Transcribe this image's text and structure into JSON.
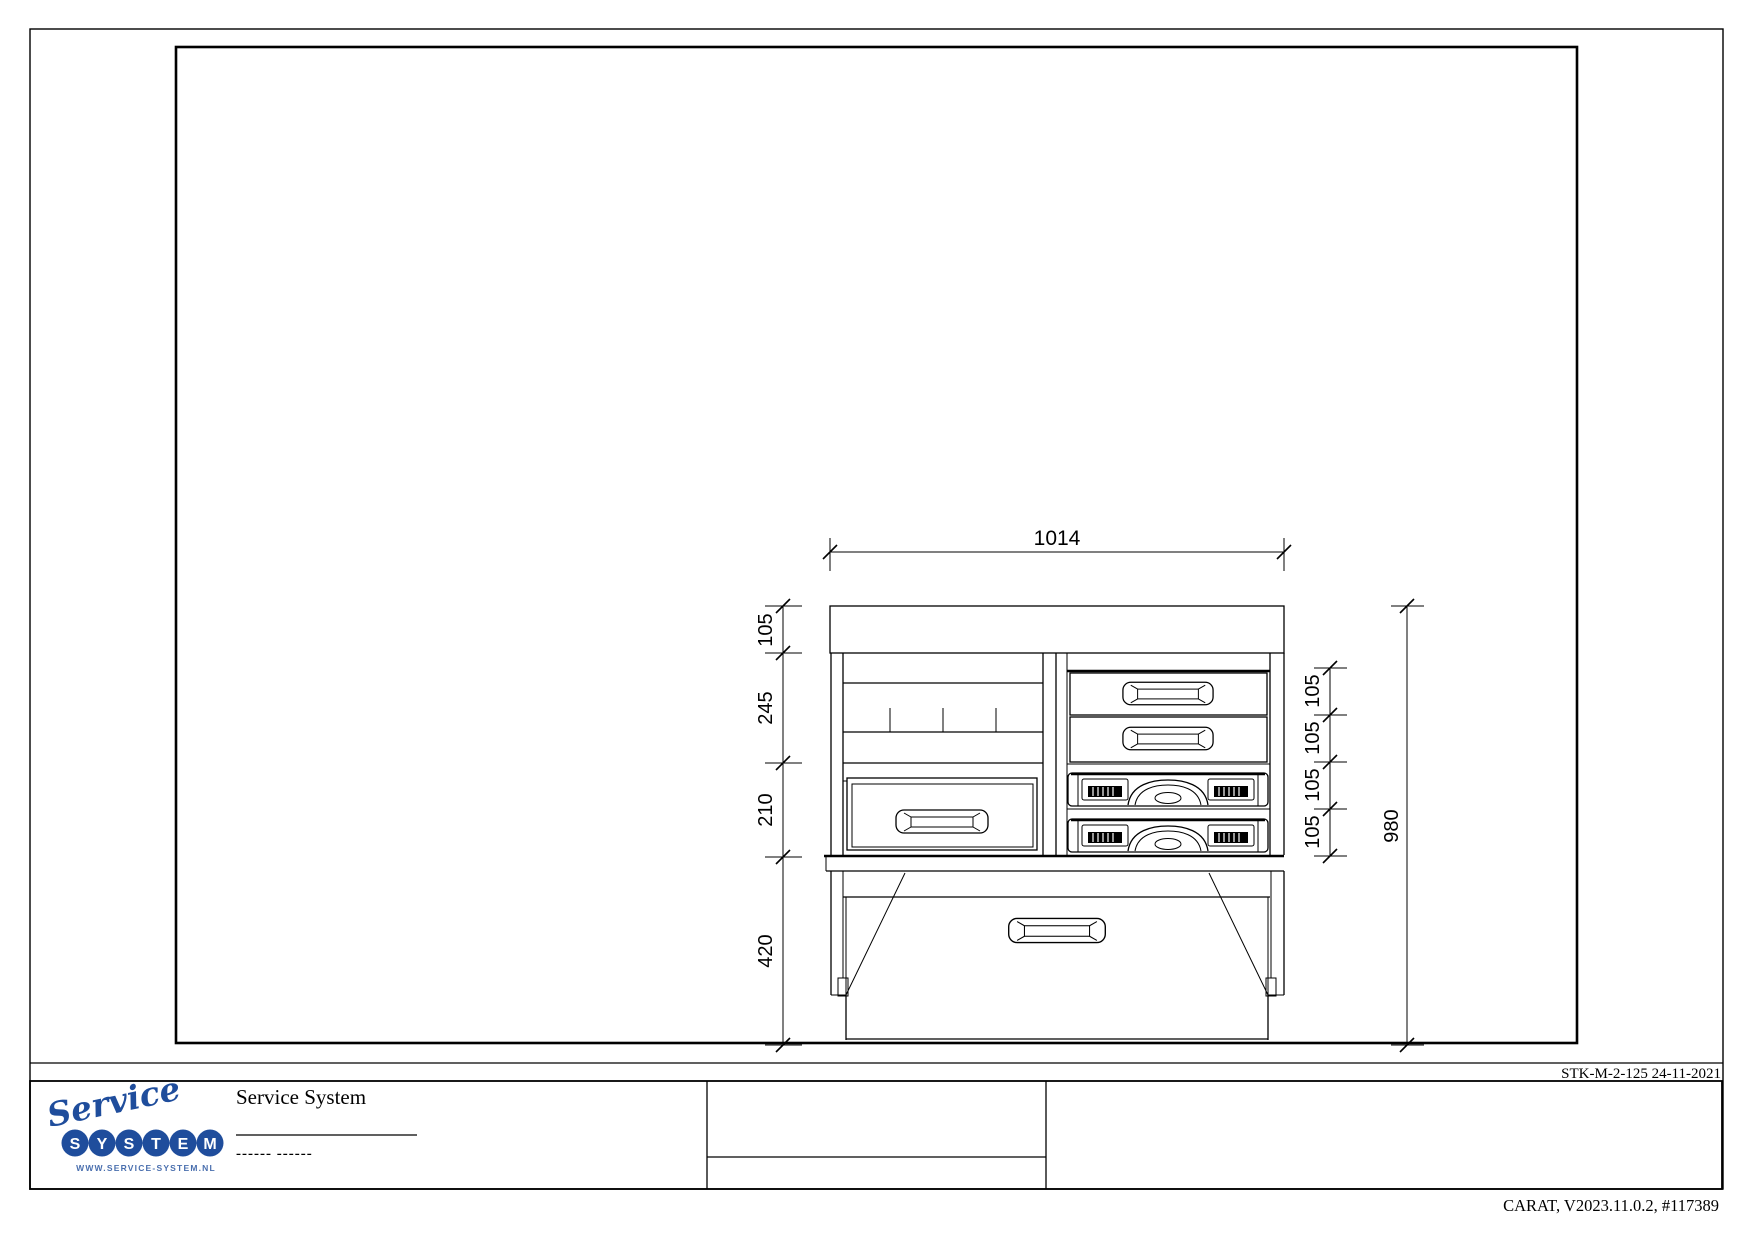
{
  "colors": {
    "ink": "#000000",
    "logo_blue": "#1f4d9c",
    "logo_blue_light": "#4a6fae",
    "paper": "#ffffff"
  },
  "drawing": {
    "dimensions": {
      "top_width": "1014",
      "left_chain": [
        "105",
        "245",
        "210",
        "420"
      ],
      "right_chain": [
        "105",
        "105",
        "105",
        "105"
      ],
      "overall_height": "980"
    }
  },
  "revision": {
    "label": "STK-M-2-125 24-11-2021"
  },
  "title_block": {
    "company": "Service System",
    "placeholder_dashes": "------ ------"
  },
  "logo": {
    "script": "Service",
    "letters": [
      "S",
      "Y",
      "S",
      "T",
      "E",
      "M"
    ],
    "website": "WWW.SERVICE-SYSTEM.NL"
  },
  "footer": {
    "version_line": "CARAT, V2023.11.0.2, #117389"
  }
}
